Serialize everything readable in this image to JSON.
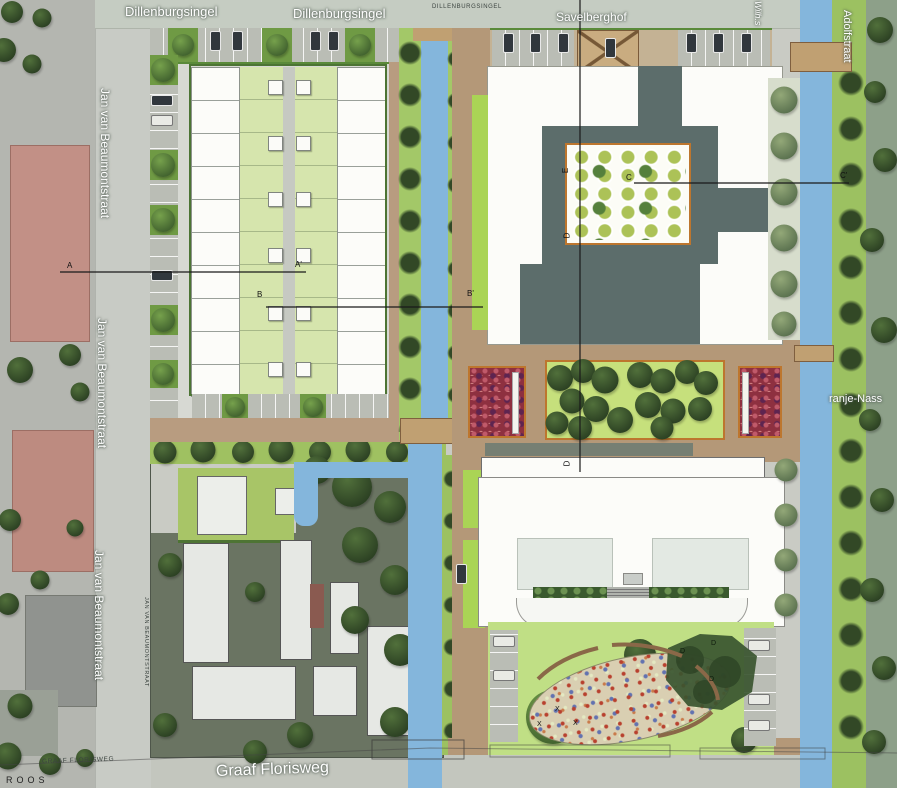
{
  "labels": {
    "dillenburgsingel": "Dillenburgsingel",
    "dillenburgsingel_caps": "DILLENBURGSINGEL",
    "savelberghof": "Savelberghof",
    "jan_van_beaumontstraat": "Jan van Beaumontstraat",
    "jan_van_beaumontstraat_caps": "JAN VAN BEAUMONTSTRAAT",
    "graaf_florisweg": "Graaf Florisweg",
    "graaf_florisweg_caps": "GRAAF FLORISWEG",
    "adolfstraat_partial": "Adolfstraat",
    "wilhelmina_partial": "Wilh.s",
    "oranje_nassau_partial": "ranje-Nass",
    "signature": "ROOS"
  },
  "markers": {
    "a": "A",
    "a_prime": "A'",
    "b": "B",
    "b_prime": "B'",
    "c": "C",
    "c_prime": "C'",
    "d": "D",
    "e": "E",
    "x": "X"
  },
  "colors": {
    "water": "#84b6dc",
    "lawn": "#c0df85",
    "garden_green": "#d6e5ad",
    "bright_verge": "#aad455",
    "dark_building": "#5c6d6b",
    "plaza_brown": "#b49878",
    "orange_border": "#bd762e",
    "red_planter": "#8e3040",
    "tree_dark": "#2c4123",
    "aerial_block": "#6a7462",
    "street_gray": "#c9cbc4"
  }
}
